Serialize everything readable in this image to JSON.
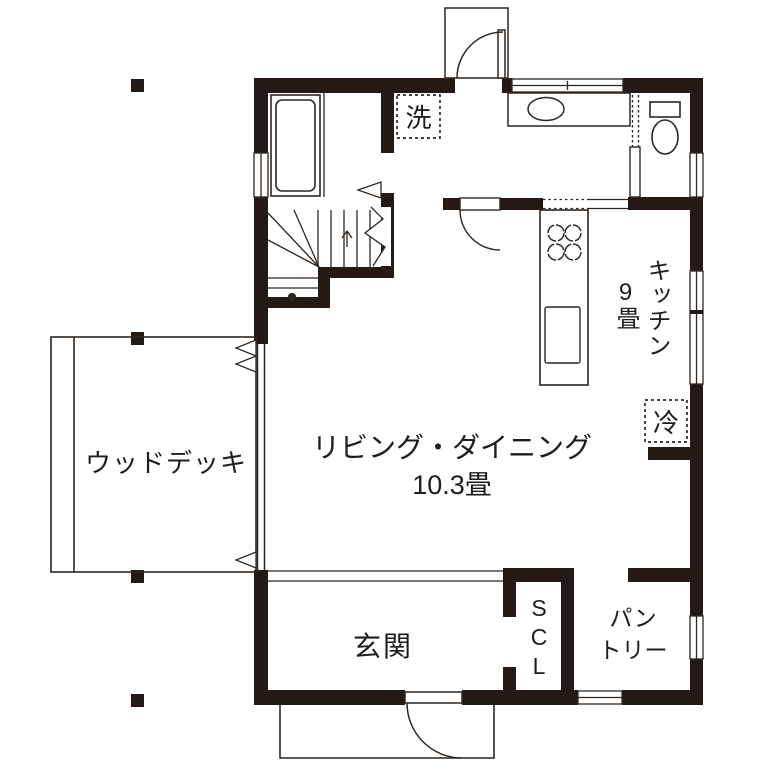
{
  "colors": {
    "wall": "#241a15",
    "line": "#2e2620"
  },
  "rooms": {
    "living_dining": {
      "label": "リビング・ダイニング",
      "size": "10.3畳"
    },
    "kitchen": {
      "label": "キッチン",
      "size": "9畳"
    },
    "wood_deck": {
      "label": "ウッドデッキ"
    },
    "genkan": {
      "label": "玄関"
    },
    "shoe_closet": {
      "label": "SCL"
    },
    "pantry": {
      "label": "パン\nトリー"
    },
    "laundry": {
      "label": "洗"
    },
    "refrigerator": {
      "label": "冷"
    }
  }
}
